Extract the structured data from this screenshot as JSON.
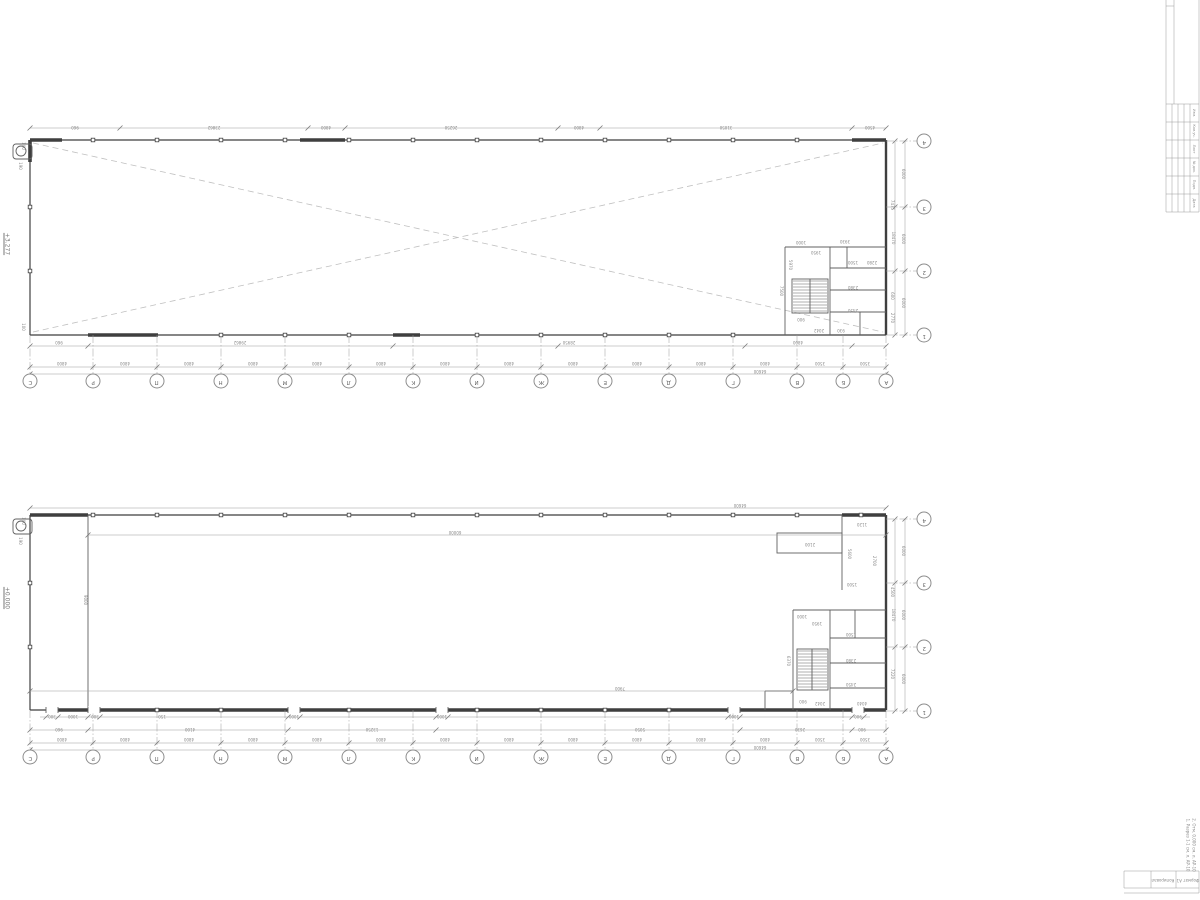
{
  "colors": {
    "bg": "#ffffff",
    "wall": "#3f3f3f",
    "part": "#606060",
    "dim": "#9a9a9a",
    "dash": "#c0c0c0",
    "txt": "#8a8a8a"
  },
  "grid": {
    "letters": [
      "С",
      "Р",
      "П",
      "Н",
      "М",
      "Л",
      "К",
      "И",
      "Ж",
      "Е",
      "Д",
      "Г",
      "В",
      "Б",
      "А"
    ],
    "numbers": [
      "4",
      "3",
      "2",
      "1"
    ]
  },
  "upper_plan": {
    "elevation": "+3.277",
    "bays": [
      "4800",
      "4800",
      "4800",
      "4800",
      "4800",
      "4800",
      "4800",
      "4800",
      "4800",
      "4800",
      "4800",
      "4800",
      "3500",
      "3500"
    ],
    "overall": "64600",
    "side_bays": [
      "6000",
      "6000",
      "6000"
    ],
    "side_overall": "18470",
    "dims": [
      [
        "960",
        75,
        127
      ],
      [
        "23862",
        214,
        127
      ],
      [
        "4800",
        326,
        127
      ],
      [
        "26250",
        451,
        127
      ],
      [
        "4800",
        579,
        127
      ],
      [
        "31050",
        726,
        127
      ],
      [
        "4500",
        870,
        127
      ],
      [
        "960",
        59,
        342
      ],
      [
        "29862",
        240,
        342
      ],
      [
        "28950",
        569,
        342
      ],
      [
        "4800",
        798,
        342
      ],
      [
        "190",
        20,
        166,
        "r90"
      ],
      [
        "100",
        23,
        146,
        "r90"
      ],
      [
        "100",
        23,
        327,
        "r90"
      ],
      [
        "7475",
        892,
        205,
        "r90"
      ],
      [
        "600",
        892,
        296,
        "r90"
      ],
      [
        "2770",
        892,
        318,
        "r90"
      ],
      [
        "3930",
        845,
        241
      ],
      [
        "1000",
        801,
        242
      ],
      [
        "1950",
        816,
        252
      ],
      [
        "1500",
        853,
        262
      ],
      [
        "2280",
        872,
        262
      ],
      [
        "2380",
        853,
        287
      ],
      [
        "2450",
        853,
        310
      ],
      [
        "900",
        801,
        319
      ],
      [
        "2042",
        819,
        330
      ],
      [
        "930",
        841,
        330
      ],
      [
        "7500",
        781,
        291,
        "r90"
      ],
      [
        "5970",
        790,
        265,
        "r90"
      ]
    ]
  },
  "lower_plan": {
    "elevation": "+0.000",
    "bays": [
      "4800",
      "4800",
      "4800",
      "4800",
      "4800",
      "4800",
      "4800",
      "4800",
      "4800",
      "4800",
      "4800",
      "4800",
      "3500",
      "3500"
    ],
    "overall": "64600",
    "side_bays": [
      "6000",
      "6000",
      "6000"
    ],
    "side_overall": "18470",
    "dims": [
      [
        "64600",
        740,
        505
      ],
      [
        "60000",
        455,
        532
      ],
      [
        "7900",
        620,
        688
      ],
      [
        "9000",
        85,
        600,
        "r90"
      ],
      [
        "190",
        20,
        541,
        "r90"
      ],
      [
        "100",
        23,
        521,
        "r90"
      ],
      [
        "1120",
        862,
        524
      ],
      [
        "5600",
        849,
        554,
        "r90"
      ],
      [
        "2700",
        874,
        561,
        "r90"
      ],
      [
        "1500",
        852,
        584
      ],
      [
        "2100",
        810,
        544
      ],
      [
        "7220",
        892,
        674,
        "r90"
      ],
      [
        "4500",
        892,
        592,
        "r90"
      ],
      [
        "6370",
        788,
        661,
        "r90"
      ],
      [
        "1000",
        802,
        616
      ],
      [
        "1950",
        817,
        623
      ],
      [
        "1500",
        851,
        634
      ],
      [
        "2380",
        851,
        660
      ],
      [
        "2450",
        851,
        684
      ],
      [
        "900",
        803,
        701
      ],
      [
        "2042",
        820,
        703
      ],
      [
        "4040",
        862,
        703
      ],
      [
        "300",
        52,
        716
      ],
      [
        "1000",
        73,
        716
      ],
      [
        "300",
        95,
        716
      ],
      [
        "150",
        162,
        716
      ],
      [
        "1000",
        294,
        716
      ],
      [
        "1000",
        442,
        716
      ],
      [
        "1000",
        734,
        716
      ],
      [
        "900",
        858,
        716
      ],
      [
        "960",
        59,
        729
      ],
      [
        "4100",
        190,
        729
      ],
      [
        "13250",
        372,
        729
      ],
      [
        "5050",
        640,
        729
      ],
      [
        "2630",
        800,
        729
      ],
      [
        "900",
        862,
        729
      ]
    ]
  },
  "title_strip": {
    "rows": [
      "Изм.",
      "Кол.уч.",
      "Лист",
      "№ док.",
      "Подп.",
      "Дата"
    ]
  },
  "notes": [
    "1. Разрез 1-1 см. л. АР-10",
    "2. Отм. 0,000 см. л. АР-10"
  ],
  "footer_cells": [
    "Копировал",
    "Формат А1"
  ]
}
